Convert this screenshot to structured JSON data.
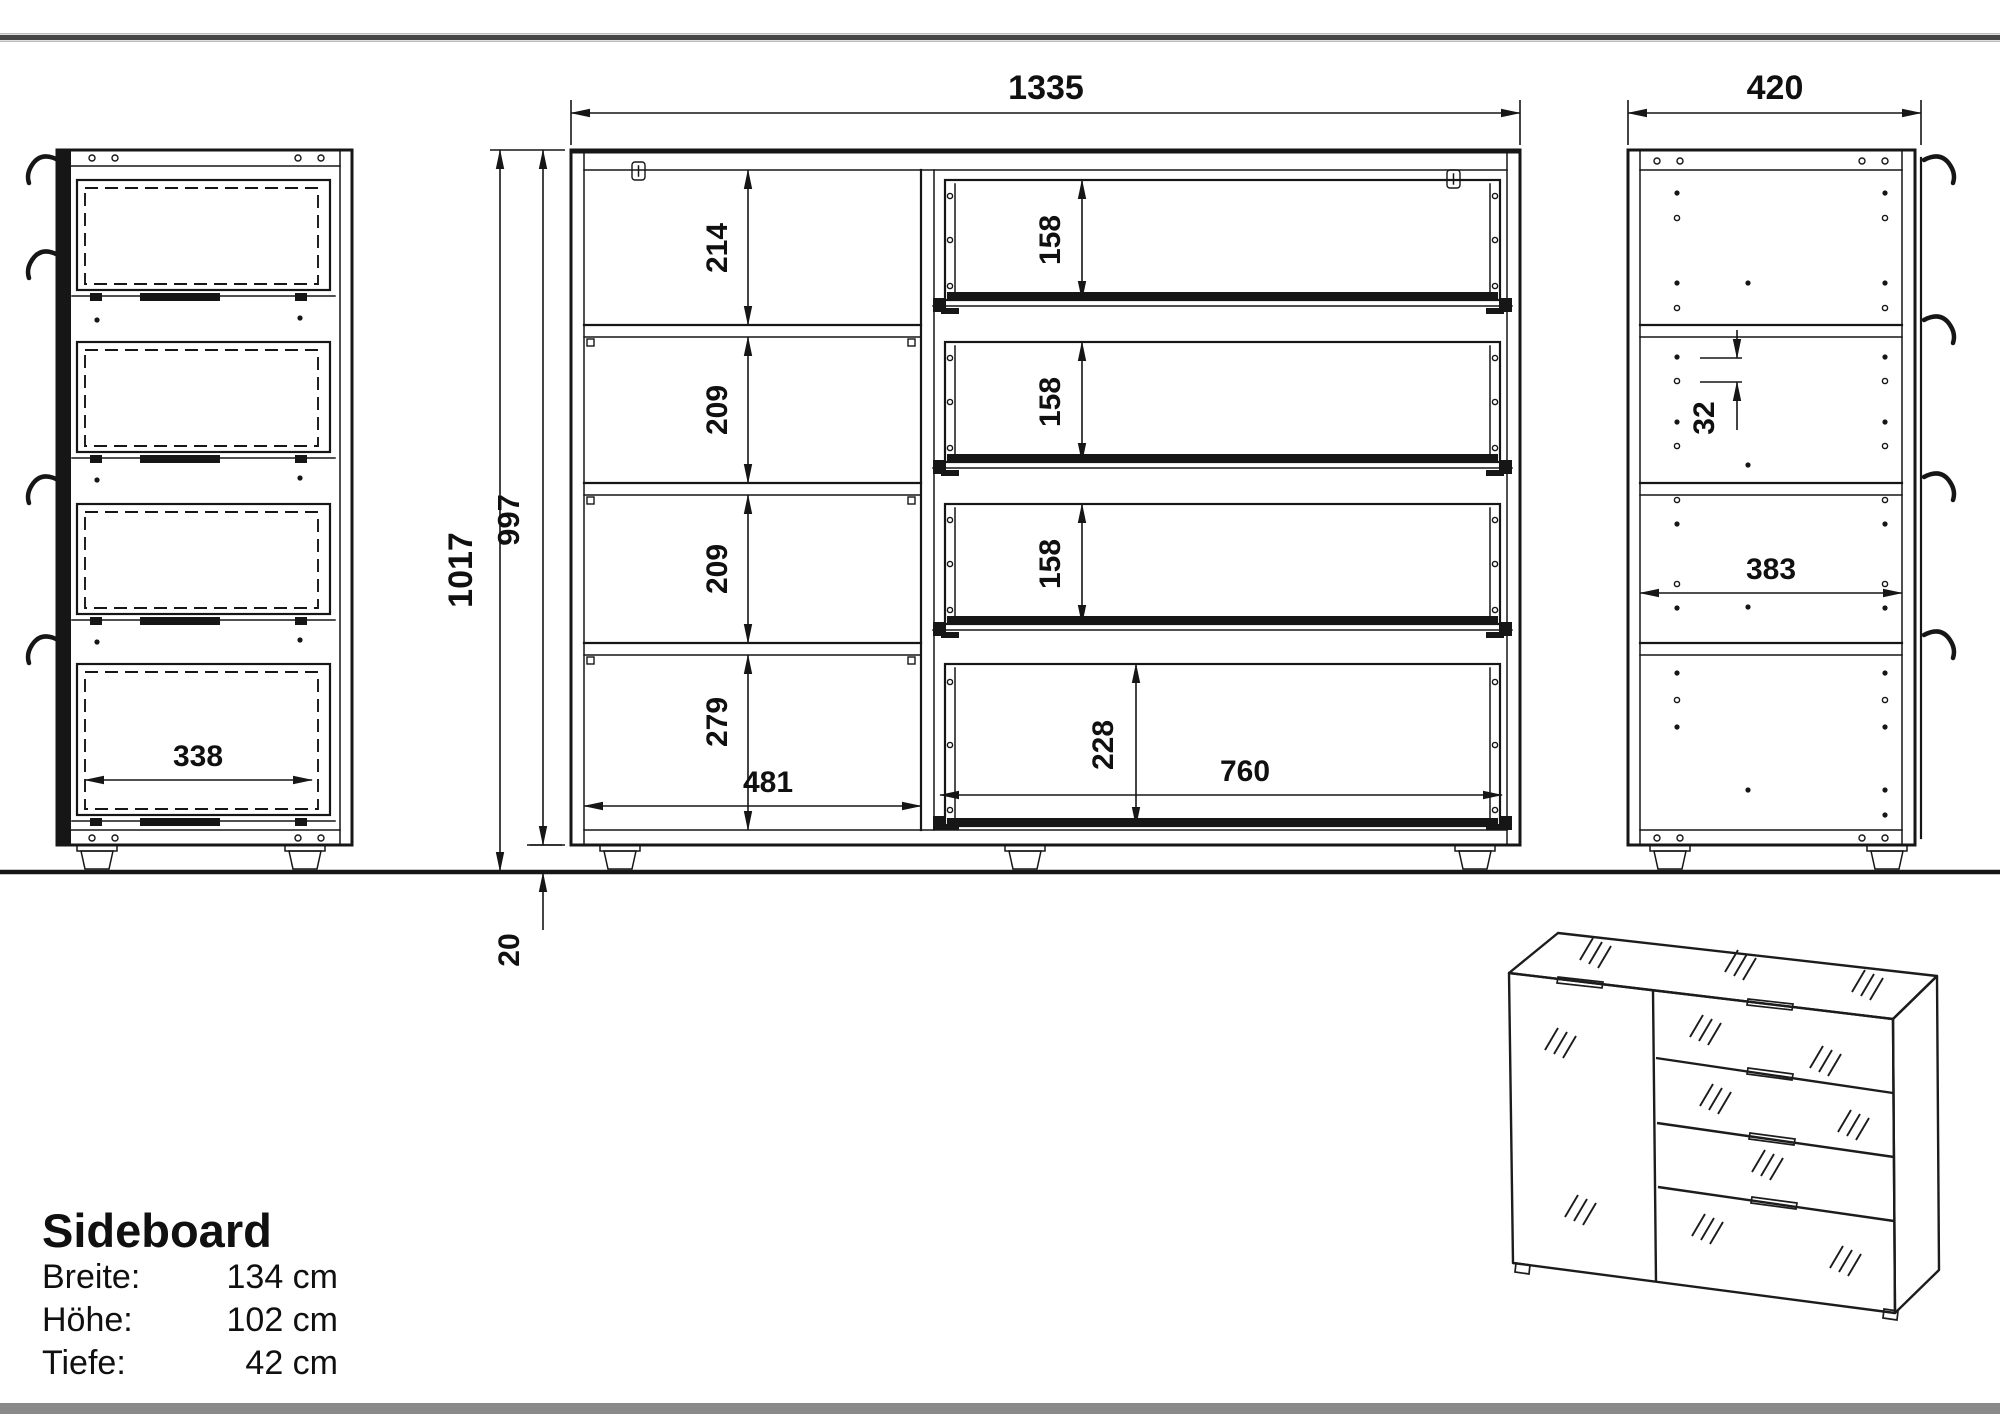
{
  "front_view": {
    "width": "1335",
    "height_total": "1017",
    "height_carcass": "997",
    "plinth_height": "20",
    "cells": [
      "214",
      "209",
      "209",
      "279"
    ],
    "left_inner_width": "481",
    "drawers": [
      "158",
      "158",
      "158"
    ],
    "bottom_drawer": "228",
    "right_inner_width": "760"
  },
  "left_side_view": {
    "drawer_inner_width": "338"
  },
  "right_side_view": {
    "depth": "420",
    "hole_pitch": "32",
    "inner_depth": "383"
  },
  "title_block": {
    "title": "Sideboard",
    "rows": [
      {
        "label": "Breite:",
        "value": "134 cm"
      },
      {
        "label": "Höhe:",
        "value": "102 cm"
      },
      {
        "label": "Tiefe:",
        "value": "42 cm"
      }
    ]
  },
  "colors": {
    "line": "#161616",
    "top_rule": "#454545",
    "bottom_bar": "#8a8a8a",
    "background": "#ffffff"
  }
}
